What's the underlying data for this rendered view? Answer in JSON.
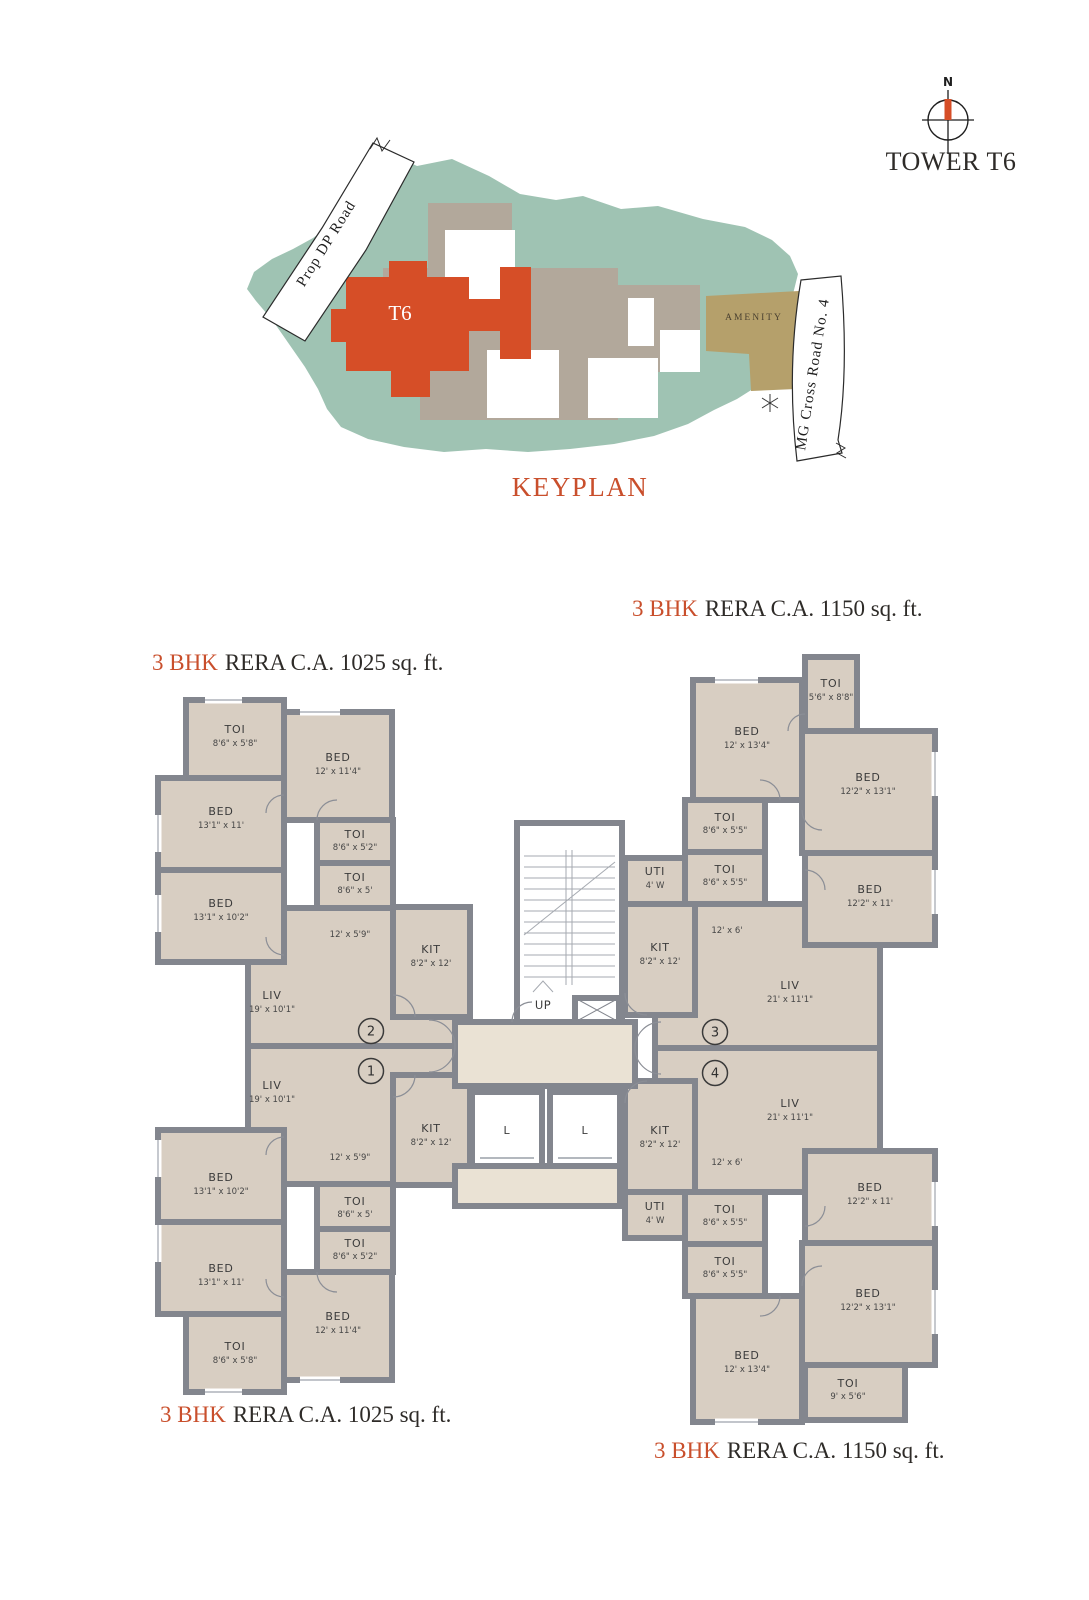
{
  "page": {
    "tower_title": "TOWER T6",
    "keyplan_title": "KEYPLAN",
    "compass_n": "N"
  },
  "keyplan": {
    "t6_label": "T6",
    "amenity_label": "AMENITY",
    "road_1": "Prop DP Road",
    "road_2": "MG Cross Road No. 4",
    "colors": {
      "site_green": "#9fc3b3",
      "building_grey": "#b2a89b",
      "highlight_red": "#d64e27",
      "amenity_tan": "#b5a06b"
    }
  },
  "floorplan": {
    "colors": {
      "room_fill": "#d8cec2",
      "wall_grey": "#83868e",
      "lobby_fill": "#eae2d4",
      "accent_red": "#c94f2c"
    },
    "area_labels": {
      "left_top": {
        "bhk": "3 BHK",
        "rest": "RERA C.A. 1025 sq. ft."
      },
      "right_top": {
        "bhk": "3 BHK",
        "rest": "RERA C.A. 1150 sq. ft."
      },
      "left_bottom": {
        "bhk": "3 BHK",
        "rest": "RERA C.A. 1025 sq. ft."
      },
      "right_bottom": {
        "bhk": "3 BHK",
        "rest": "RERA C.A. 1150 sq. ft."
      }
    },
    "unit_numbers": {
      "u1": "1",
      "u2": "2",
      "u3": "3",
      "u4": "4"
    },
    "core": {
      "up": "UP",
      "dn": "DN",
      "lift1": "L",
      "lift2": "L"
    },
    "rooms": {
      "u2_toi_a": {
        "name": "TOI",
        "dim": "8'6\" x 5'8\""
      },
      "u2_bed_b": {
        "name": "BED",
        "dim": "12' x 11'4\""
      },
      "u2_bed_c": {
        "name": "BED",
        "dim": "13'1\" x 11'"
      },
      "u2_toi_d": {
        "name": "TOI",
        "dim": "8'6\" x 5'2\""
      },
      "u2_toi_e": {
        "name": "TOI",
        "dim": "8'6\" x 5'"
      },
      "u2_bed_f": {
        "name": "BED",
        "dim": "13'1\" x 10'2\""
      },
      "u2_pass": {
        "dim": "12' x 5'9\""
      },
      "u2_kit": {
        "name": "KIT",
        "dim": "8'2\" x 12'"
      },
      "u2_liv": {
        "name": "LIV",
        "dim": "19' x 10'1\""
      },
      "u1_liv": {
        "name": "LIV",
        "dim": "19' x 10'1\""
      },
      "u1_kit": {
        "name": "KIT",
        "dim": "8'2\" x 12'"
      },
      "u1_pass": {
        "dim": "12' x 5'9\""
      },
      "u1_bed_f": {
        "name": "BED",
        "dim": "13'1\" x 10'2\""
      },
      "u1_toi_e": {
        "name": "TOI",
        "dim": "8'6\" x 5'"
      },
      "u1_toi_d": {
        "name": "TOI",
        "dim": "8'6\" x 5'2\""
      },
      "u1_bed_c": {
        "name": "BED",
        "dim": "13'1\" x 11'"
      },
      "u1_bed_b": {
        "name": "BED",
        "dim": "12' x 11'4\""
      },
      "u1_toi_a": {
        "name": "TOI",
        "dim": "8'6\" x 5'8\""
      },
      "u3_toi_g": {
        "name": "TOI",
        "dim": "5'6\" x 8'8\""
      },
      "u3_bed_h": {
        "name": "BED",
        "dim": "12' x 13'4\""
      },
      "u3_bed_i": {
        "name": "BED",
        "dim": "12'2\" x 13'1\""
      },
      "u3_toi_j": {
        "name": "TOI",
        "dim": "8'6\" x 5'5\""
      },
      "u3_toi_k": {
        "name": "TOI",
        "dim": "8'6\" x 5'5\""
      },
      "u3_uti": {
        "name": "UTI",
        "dim": "4' W"
      },
      "u3_kit": {
        "name": "KIT",
        "dim": "8'2\" x 12'"
      },
      "u3_bed_l": {
        "name": "BED",
        "dim": "12'2\" x 11'"
      },
      "u3_pass": {
        "dim": "12' x 6'"
      },
      "u3_liv": {
        "name": "LIV",
        "dim": "21' x 11'1\""
      },
      "u4_liv": {
        "name": "LIV",
        "dim": "21' x 11'1\""
      },
      "u4_kit": {
        "name": "KIT",
        "dim": "8'2\" x 12'"
      },
      "u4_uti": {
        "name": "UTI",
        "dim": "4' W"
      },
      "u4_pass": {
        "dim": "12' x 6'"
      },
      "u4_toi_m": {
        "name": "TOI",
        "dim": "8'6\" x 5'5\""
      },
      "u4_toi_n": {
        "name": "TOI",
        "dim": "8'6\" x 5'5\""
      },
      "u4_bed_o": {
        "name": "BED",
        "dim": "12'2\" x 11'"
      },
      "u4_bed_p": {
        "name": "BED",
        "dim": "12'2\" x 13'1\""
      },
      "u4_bed_q": {
        "name": "BED",
        "dim": "12' x 13'4\""
      },
      "u4_toi_r": {
        "name": "TOI",
        "dim": "9' x 5'6\""
      }
    }
  }
}
